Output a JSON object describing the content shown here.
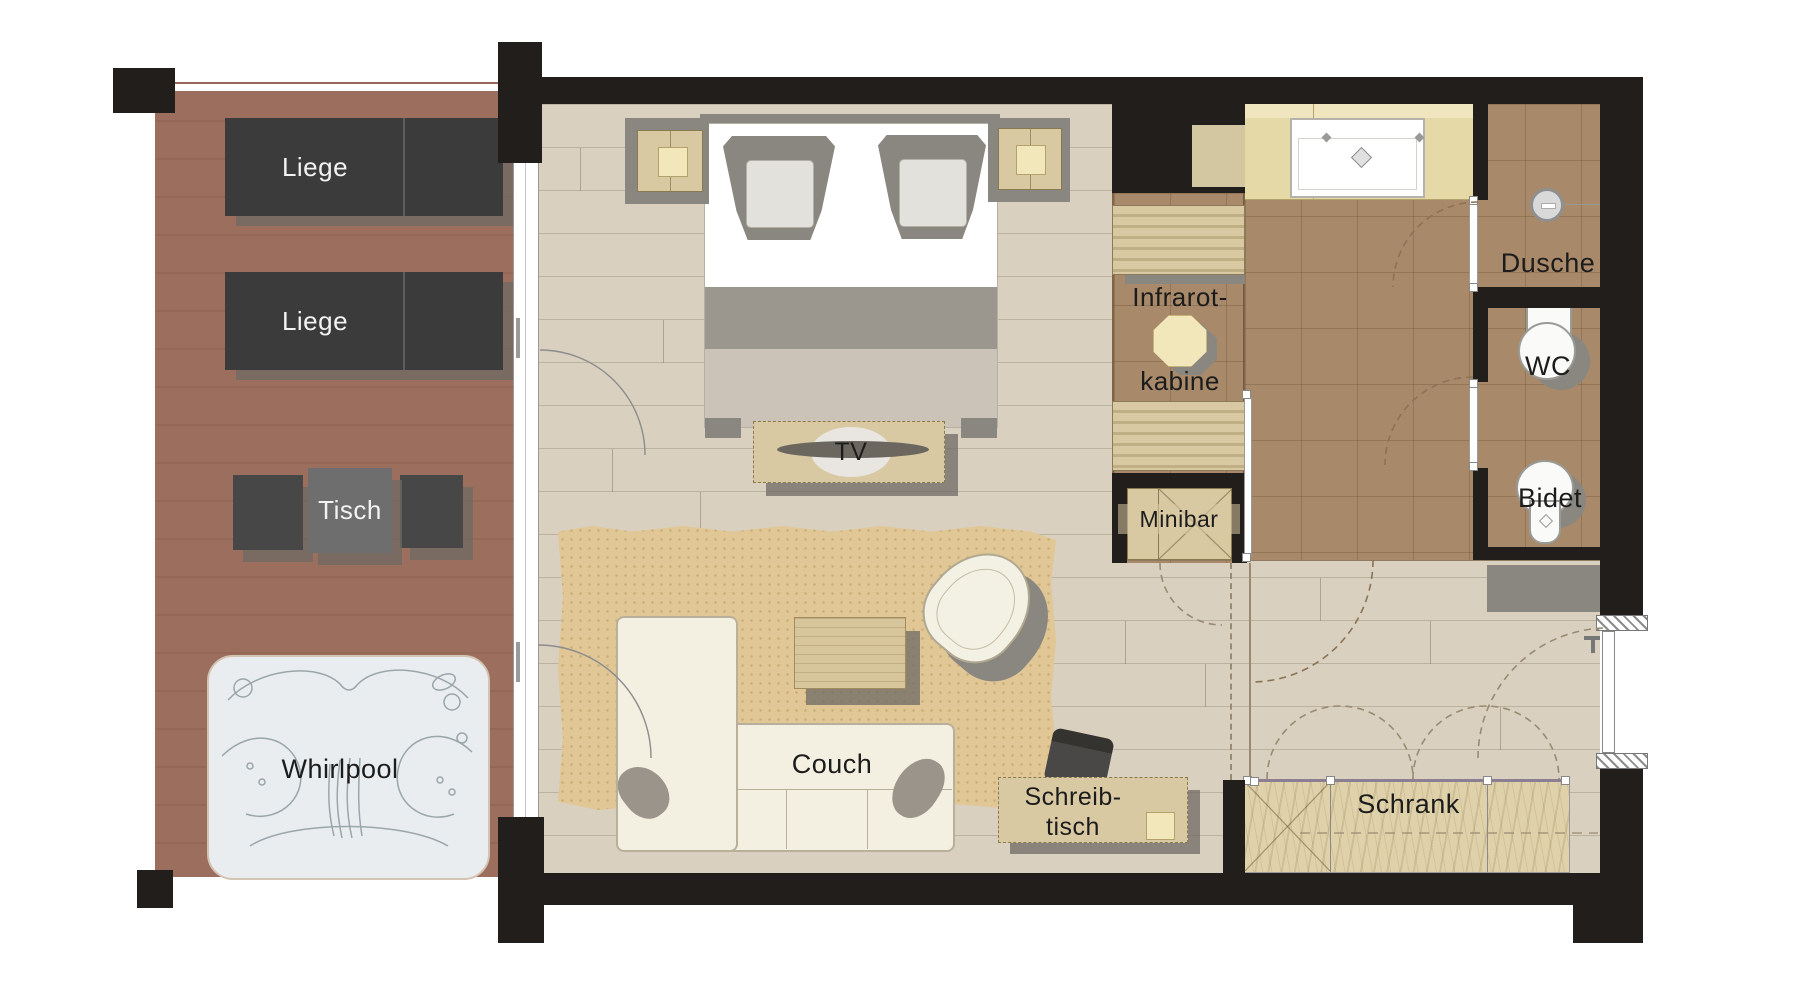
{
  "plan": {
    "type": "hotel-suite-floor-plan",
    "terrace": {
      "lounger_top": "Liege",
      "lounger_bottom": "Liege",
      "table": "Tisch",
      "whirlpool": "Whirlpool"
    },
    "living": {
      "tv": "TV",
      "couch": "Couch",
      "desk_line1": "Schreib-",
      "desk_line2": "tisch",
      "wardrobe": "Schrank",
      "minibar": "Minibar"
    },
    "bath": {
      "infrared_line1": "Infrarot-",
      "infrared_line2": "kabine",
      "shower": "Dusche",
      "wc": "WC",
      "bidet": "Bidet"
    },
    "colors": {
      "wall": "#211e1b",
      "terrace_floor": "#9c6e5d",
      "wood_floor": "#d9d0bf",
      "bath_tile": "#a8896a",
      "rug": "#e0c795",
      "furniture_beige": "#d9c9a3",
      "furniture_dark": "#3b3b3b",
      "couch_cream": "#f3efe1",
      "shadow_gray": "#8a8680",
      "whirlpool_fill": "#e9edf0"
    }
  }
}
